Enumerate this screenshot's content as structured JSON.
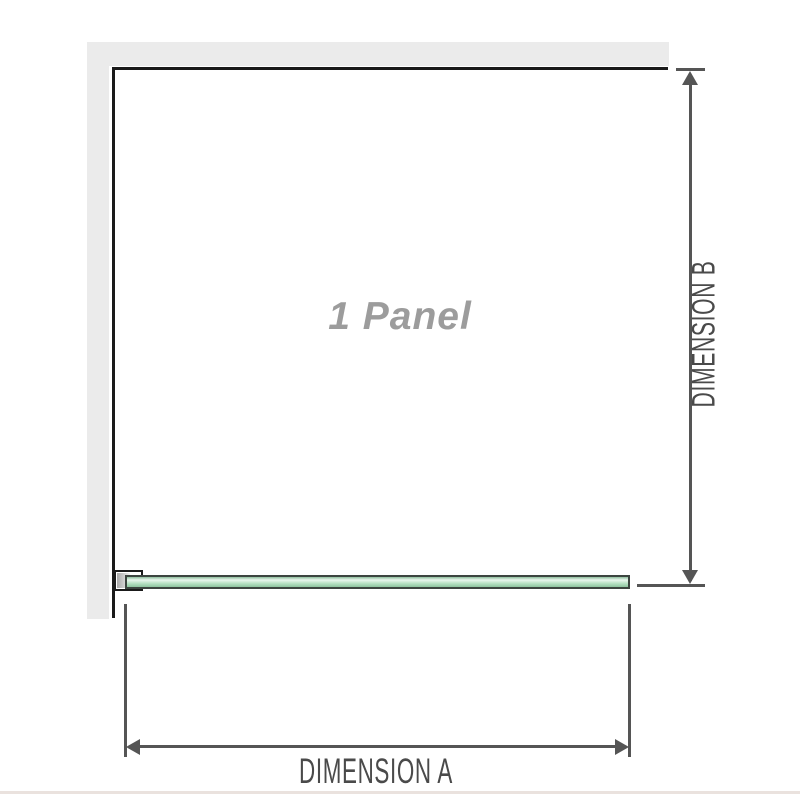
{
  "diagram": {
    "panel_label": "1 Panel",
    "dimension_a_label": "DIMENSION A",
    "dimension_b_label": "DIMENSION B"
  },
  "colors": {
    "wall": "#ebebeb",
    "outline": "#1a1a1a",
    "dim": "#555555",
    "dimtext": "#4a4a4a",
    "paneltext": "#9c9c9c",
    "glassborder": "#3c4540",
    "baseline": "#eae2de"
  }
}
